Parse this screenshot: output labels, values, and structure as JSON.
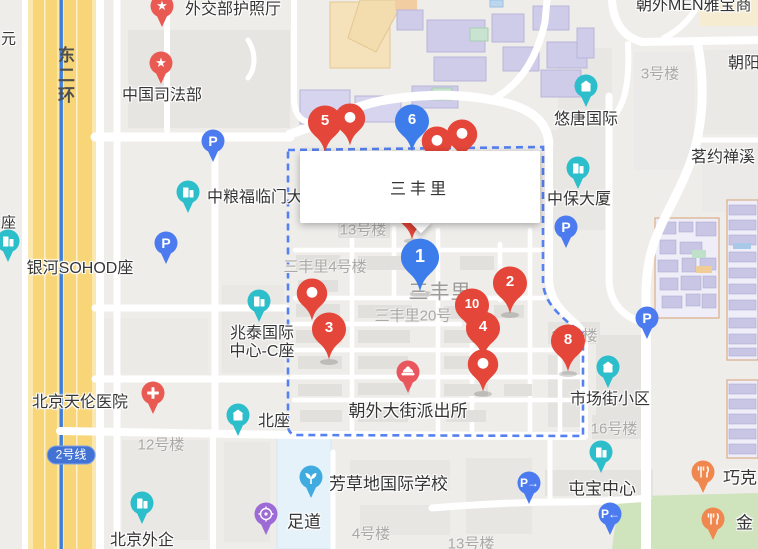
{
  "infowindow": {
    "title": "三丰里"
  },
  "markers": {
    "m1": {
      "label": "1",
      "color": "blue"
    },
    "m2": {
      "label": "2",
      "color": "red"
    },
    "m3": {
      "label": "3",
      "color": "red"
    },
    "m4": {
      "label": "4",
      "color": "red"
    },
    "m5": {
      "label": "5",
      "color": "red"
    },
    "m6": {
      "label": "6",
      "color": "blue"
    },
    "m8": {
      "label": "8",
      "color": "red"
    },
    "m10": {
      "label": "10",
      "color": "red"
    }
  },
  "pois": {
    "passport_office": "外交部护照厅",
    "ministry_of_justice": "中国司法部",
    "cofco_fulinmen": "中粮福临门大",
    "galaxy_soho": "银河SOHOD座",
    "zhaotai_line1": "兆泰国际",
    "zhaotai_line2": "中心-C座",
    "tianlun_hospital": "北京天伦医院",
    "north_block": "北座",
    "beijing_fesco": "北京外企",
    "fangcaodi_school": "芳草地国际学校",
    "foot_spa": "足道",
    "police_station": "朝外大街派出所",
    "market_street_block": "市场街小区",
    "tunbao_center": "屯宝中心",
    "youtang_intl": "悠唐国际",
    "zhongbao_tower": "中保大厦",
    "mingyue_chanxi": "茗约禅溪",
    "chaoyang_partial": "朝阳",
    "chaowai_men_yabao": "朝外MEN雅宝商",
    "chocolate_partial": "巧克",
    "jin_partial": "金",
    "yuan_partial": "元",
    "zuo_partial": "座"
  },
  "building_labels": {
    "b3": "3号楼",
    "b13_top": "13号楼",
    "sanfengli_4": "三丰里4号楼",
    "sanfengli_big": "三丰里",
    "sanfengli_20": "三丰里20号",
    "b12": "12号楼",
    "b4": "4号楼",
    "b13_bottom": "13号楼",
    "b16": "16号楼",
    "b18": "18号楼"
  },
  "transit": {
    "ring_road": "东二环",
    "line2_badge": "2号线"
  },
  "icons": {
    "parking": "P",
    "star": "★",
    "arrow_right": "→",
    "arrow_left": "←"
  },
  "colors": {
    "marker_red": "#E5463A",
    "marker_blue": "#3D7DEB",
    "poi_teal": "#2CBECB",
    "parking_blue": "#4C7BF0",
    "poi_rose": "#E95A52",
    "restaurant_orange": "#F0874E",
    "spa_purple": "#9D6BD5",
    "school_blue": "#3FABDF",
    "boundary_blue": "#4D7BF0",
    "highway_yellow": "#F8D677",
    "metro_blue": "#3F7ED8",
    "park_green": "#CFE3BD"
  }
}
